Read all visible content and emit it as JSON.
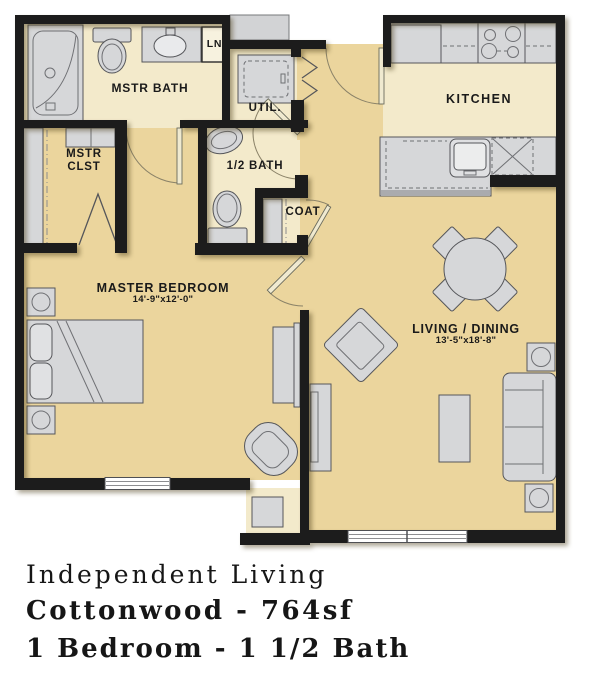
{
  "colors": {
    "wall": "#1c1c1c",
    "floor_tan": "#ebd59d",
    "floor_cream": "#f3eacb",
    "fixture_fill": "#d6d7d9",
    "fixture_stroke": "#55565a",
    "text": "#1a1a1a"
  },
  "rooms": {
    "master_bath": {
      "label": "MSTR BATH"
    },
    "linen": {
      "label": "LN"
    },
    "utility": {
      "label": "UTIL."
    },
    "half_bath": {
      "label": "1/2 BATH"
    },
    "coat": {
      "label": "COAT"
    },
    "master_closet": {
      "label_line1": "MSTR",
      "label_line2": "CLST"
    },
    "master_bedroom": {
      "label": "MASTER BEDROOM",
      "dimensions": "14'-9\"x12'-0\""
    },
    "kitchen": {
      "label": "KITCHEN"
    },
    "living_dining": {
      "label": "LIVING / DINING",
      "dimensions": "13'-5\"x18'-8\""
    }
  },
  "caption": {
    "line1": "Independent Living",
    "line2": "Cottonwood - 764sf",
    "line3": "1 Bedroom - 1 1/2 Bath"
  }
}
